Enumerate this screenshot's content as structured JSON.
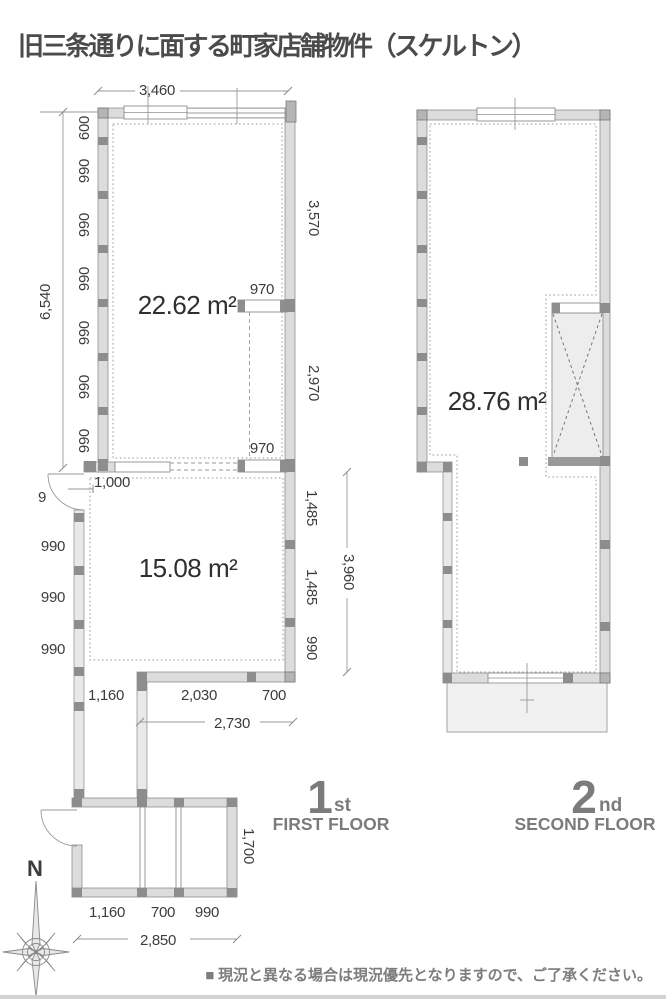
{
  "title": "旧三条通りに面する町家店舗物件（スケルトン）",
  "footer": "■ 現況と異なる場合は現況優先となりますので、ご了承ください。",
  "compass": {
    "north_label": "N"
  },
  "floor1": {
    "width_top": "3,460",
    "left_dims": [
      "600",
      "990",
      "990",
      "990",
      "990",
      "990",
      "990"
    ],
    "left_total": "6,540",
    "right_dims_upper": [
      "3,570",
      "2,970"
    ],
    "opening_upper": "970",
    "opening_lower": "970",
    "door_width": "1,000",
    "dim_partial": "9",
    "left_dims_lower": [
      "990",
      "990",
      "990"
    ],
    "right_dims_lower": [
      "1,485",
      "1,485",
      "990"
    ],
    "right_total_lower": "3,960",
    "bottom_dims": [
      "1,160",
      "2,030",
      "700"
    ],
    "bottom_total": "2,730",
    "entrance_dims": [
      "1,160",
      "700",
      "990"
    ],
    "entrance_total": "2,850",
    "entrance_depth": "1,700",
    "room_upper_area": "22.62 m²",
    "room_lower_area": "15.08 m²",
    "floor_number": "1",
    "floor_ordinal": "st",
    "floor_name": "FIRST FLOOR"
  },
  "floor2": {
    "room_area": "28.76 m²",
    "floor_number": "2",
    "floor_ordinal": "nd",
    "floor_name": "SECOND FLOOR"
  }
}
